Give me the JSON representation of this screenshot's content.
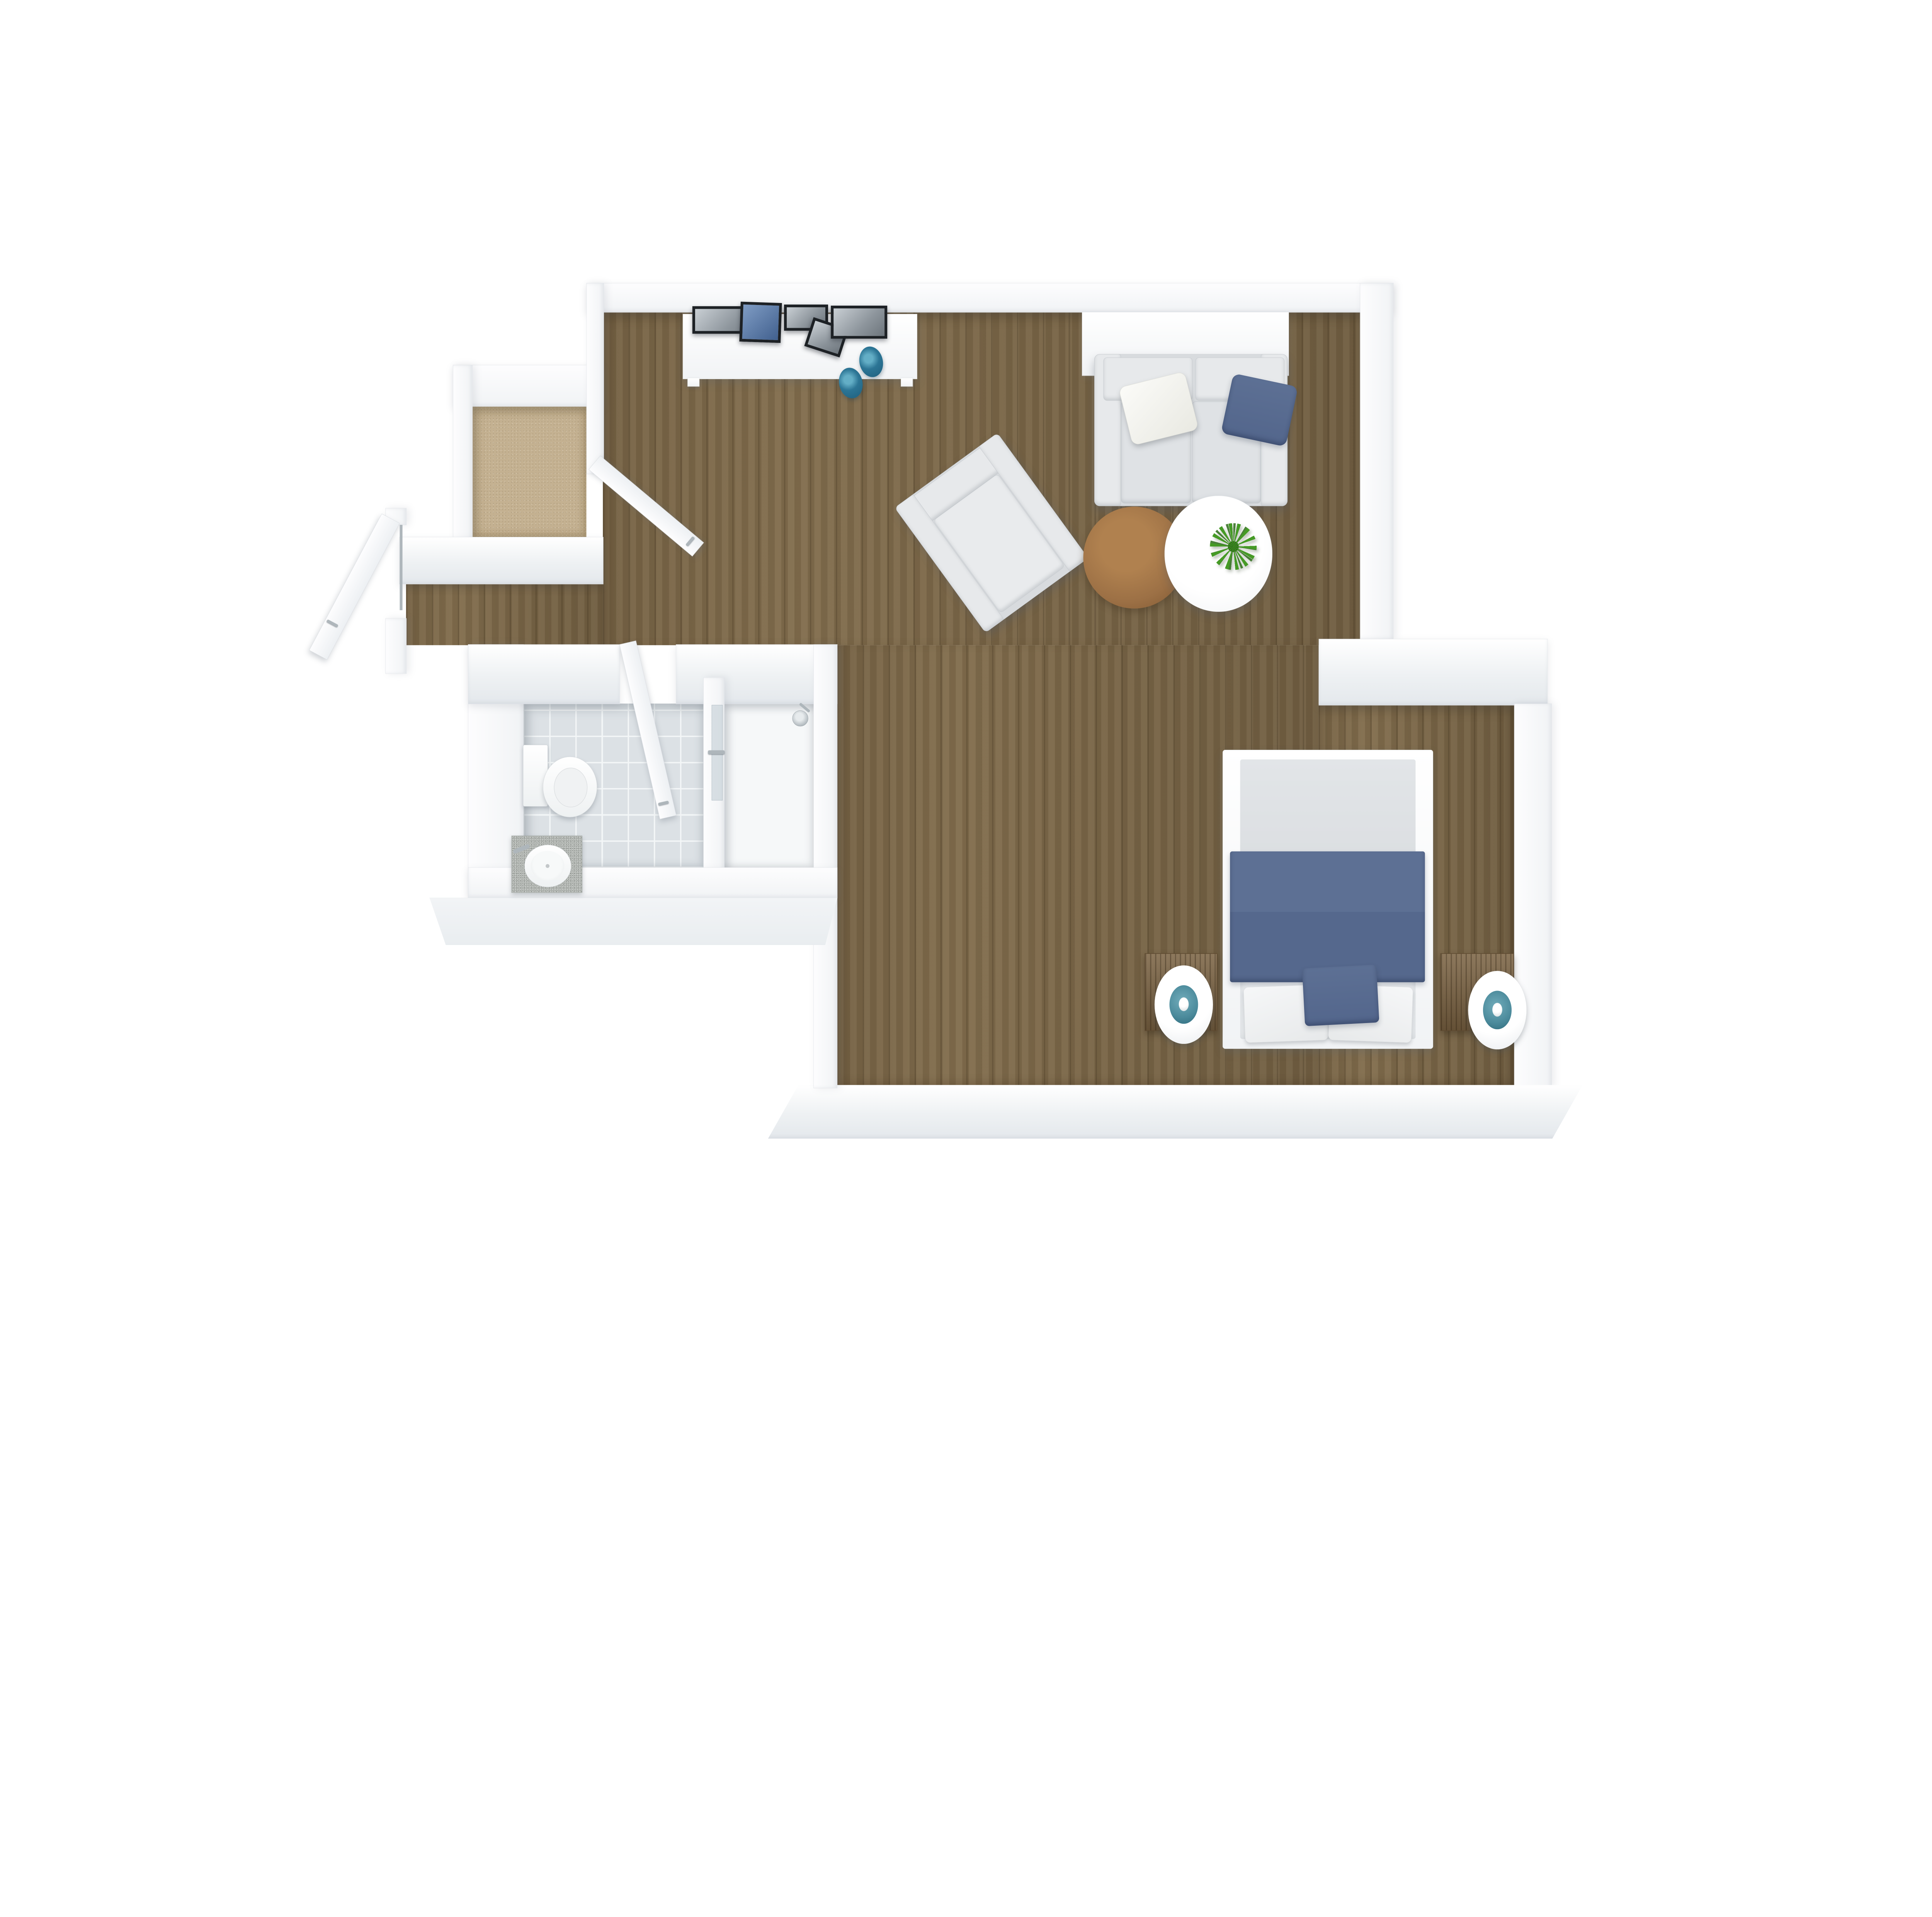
{
  "document": {
    "type": "3d-floor-plan-rendering",
    "view": "top-down",
    "description": "Top-down 3D rendering of a studio apartment with living area, sleeping nook, entry closet and bathroom with shower"
  },
  "palette": {
    "page_bg": "#ffffff",
    "wall_top": "#fdfdfe",
    "wall_face": "#f1f3f5",
    "wall_edge": "#e1e4e8",
    "wood_floor": "#806c4d",
    "wood_dark": "#66543a",
    "carpet": "#c4b191",
    "tile": "#dce1e5",
    "tile_grout": "#f3f6f7",
    "shower_floor": "#f6f8f9",
    "fabric": "#d8dbde",
    "fabric_light": "#e7e9eb",
    "fabric_edge": "#c4c9ce",
    "white_furniture": "#fbfcfd",
    "mattress": "#eef0f2",
    "duvet_gray": "#dcdfe2",
    "textile_blue": "#56698c",
    "textile_blue_dark": "#4b5d80",
    "bowl_teal": "#2c7595",
    "lamp_teal": "#4b8a9b",
    "nightstand_wood": "#7a6242",
    "nightstand_edge": "#5d4930",
    "coffee_wood": "#9c7045",
    "plant_green": "#459a25",
    "plant_green_dark": "#2e6e1a",
    "chrome": "#aeb6bb",
    "granite": "#b6bab6",
    "frame_black": "#1d2125",
    "photo_blue": "#41608e",
    "photo_gray": "#8d959c"
  },
  "rooms": [
    {
      "id": "living-area",
      "floor": "hardwood",
      "furniture": [
        "console-table",
        "loveseat-sofa",
        "accent-armchair",
        "round-coffee-table",
        "oval-coffee-table",
        "potted-plant"
      ]
    },
    {
      "id": "sleeping-area",
      "floor": "hardwood",
      "furniture": [
        "double-bed",
        "nightstand-left",
        "nightstand-right",
        "table-lamp-left",
        "table-lamp-right"
      ]
    },
    {
      "id": "entry-closet",
      "floor": "carpet",
      "furniture": []
    },
    {
      "id": "entry-vestibule",
      "floor": "hardwood",
      "furniture": [
        "entry-door",
        "closet-door"
      ]
    },
    {
      "id": "bathroom",
      "floor": "ceramic-tile",
      "furniture": [
        "toilet",
        "vanity-sink",
        "bathroom-door"
      ]
    },
    {
      "id": "shower-room",
      "floor": "shower-tray",
      "furniture": [
        "glass-panel",
        "shower-head"
      ]
    }
  ],
  "decor": {
    "console_picture_frames": 5,
    "console_bowls": 2,
    "sofa_pillows": [
      "white",
      "blue"
    ],
    "bed_textiles": [
      "gray-folded-duvet",
      "blue-blanket",
      "white-pillow-left",
      "white-pillow-right",
      "blue-accent-cushion"
    ]
  }
}
